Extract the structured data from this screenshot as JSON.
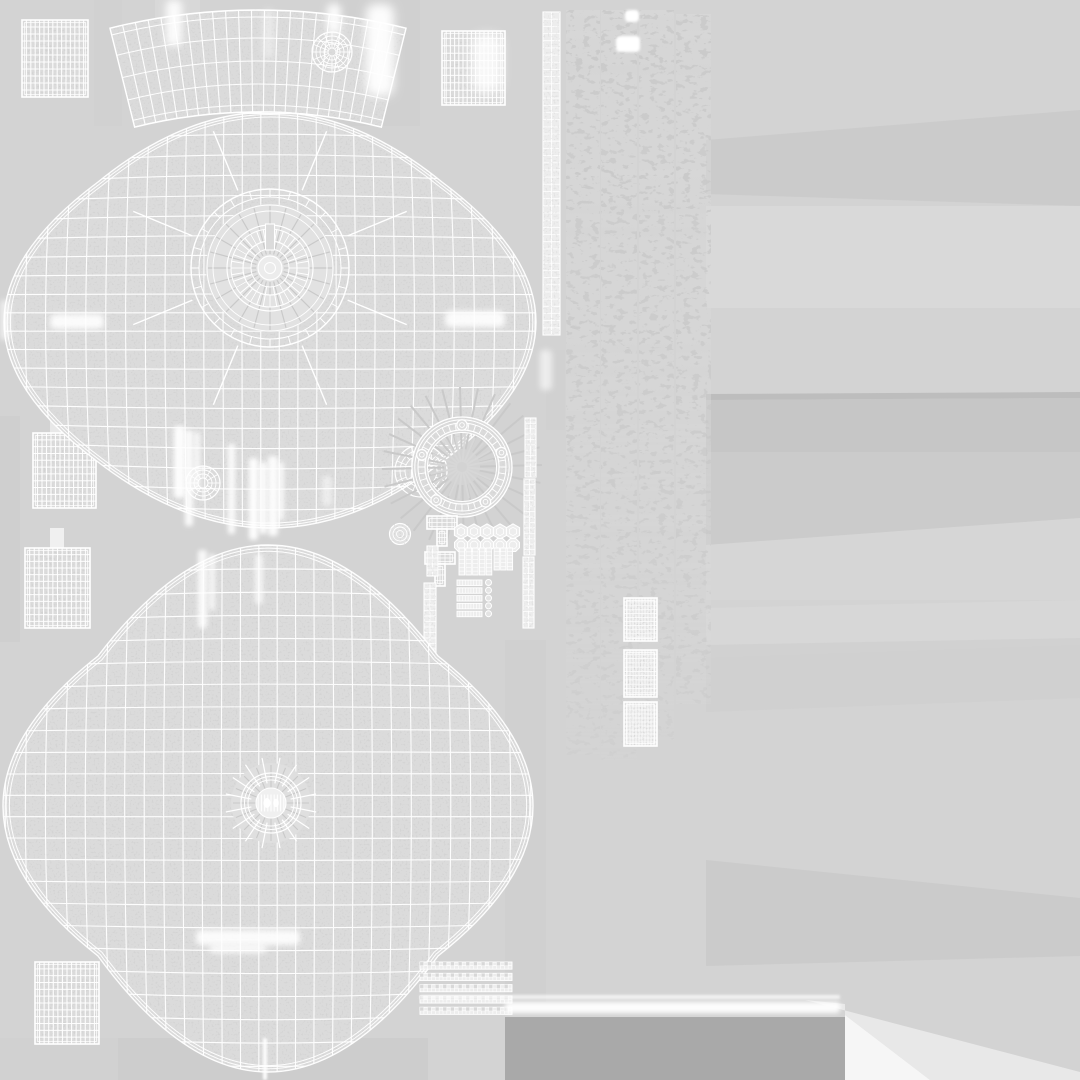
{
  "meta": {
    "title": "UV Wireframe Texture Atlas",
    "description": "Grayscale UV-unwrap wireframe sheet of a 3D drum-style model: two cross-shaped shell islands, top arc band, hoop ring, lugs, tension rods, ladder strips and grid patches on a gray background",
    "canvas": {
      "width": 1080,
      "height": 1080
    }
  },
  "palette": {
    "background": "#d3d3d3",
    "island_fill": "#dbdbdb",
    "island_light": "#e6e6e6",
    "wire": "#ffffff",
    "faint_wire": "#cfcfcf",
    "sunburst": "#c9c9c9",
    "dark_rect": "#a9a9a9",
    "white_patch": "#f6f6f6",
    "pale_corner": "#eaeaea",
    "part_fill": "#ededed"
  },
  "background": {
    "streaks": [
      {
        "pts": [
          [
            706,
            140
          ],
          [
            1080,
            110
          ],
          [
            1080,
            206
          ],
          [
            706,
            194
          ]
        ],
        "f": "#c9c9c9",
        "o": 0.8
      },
      {
        "pts": [
          [
            706,
            206
          ],
          [
            1080,
            206
          ],
          [
            1080,
            308
          ],
          [
            706,
            308
          ]
        ],
        "f": "#dcdcdc",
        "o": 0.7
      },
      {
        "pts": [
          [
            706,
            394
          ],
          [
            1080,
            392
          ],
          [
            1080,
            398
          ],
          [
            706,
            400
          ]
        ],
        "f": "#ababab",
        "o": 0.55
      },
      {
        "pts": [
          [
            706,
            400
          ],
          [
            1080,
            398
          ],
          [
            1080,
            452
          ],
          [
            706,
            452
          ]
        ],
        "f": "#c3c3c3",
        "o": 0.8
      },
      {
        "pts": [
          [
            706,
            452
          ],
          [
            1080,
            452
          ],
          [
            1080,
            518
          ],
          [
            706,
            545
          ]
        ],
        "f": "#c7c7c7",
        "o": 0.7
      },
      {
        "pts": [
          [
            706,
            545
          ],
          [
            1080,
            518
          ],
          [
            1080,
            600
          ],
          [
            706,
            600
          ]
        ],
        "f": "#d8d8d8",
        "o": 0.6
      },
      {
        "pts": [
          [
            706,
            608
          ],
          [
            1080,
            600
          ],
          [
            1080,
            645
          ],
          [
            706,
            658
          ]
        ],
        "f": "#d9d9d9",
        "o": 0.7
      },
      {
        "pts": [
          [
            706,
            645
          ],
          [
            1080,
            638
          ],
          [
            1080,
            698
          ],
          [
            706,
            712
          ]
        ],
        "f": "#cecece",
        "o": 0.7
      },
      {
        "pts": [
          [
            706,
            860
          ],
          [
            1080,
            898
          ],
          [
            1080,
            956
          ],
          [
            706,
            966
          ]
        ],
        "f": "#c8c8c8",
        "o": 0.75
      },
      {
        "pts": [
          [
            88,
            336
          ],
          [
            122,
            336
          ],
          [
            122,
            448
          ],
          [
            88,
            448
          ]
        ],
        "f": "#c8c8c8",
        "o": 0.5
      },
      {
        "pts": [
          [
            294,
            328
          ],
          [
            368,
            328
          ],
          [
            368,
            434
          ],
          [
            294,
            434
          ]
        ],
        "f": "#cccccc",
        "o": 0.5
      },
      {
        "pts": [
          [
            338,
            0
          ],
          [
            420,
            0
          ],
          [
            420,
            126
          ],
          [
            338,
            126
          ]
        ],
        "f": "#cdcdcd",
        "o": 0.45
      },
      {
        "pts": [
          [
            94,
            0
          ],
          [
            122,
            0
          ],
          [
            122,
            126
          ],
          [
            94,
            126
          ]
        ],
        "f": "#d0d0d0",
        "o": 0.5
      },
      {
        "pts": [
          [
            0,
            416
          ],
          [
            20,
            416
          ],
          [
            20,
            642
          ],
          [
            0,
            642
          ]
        ],
        "f": "#cbcbcb",
        "o": 0.5
      },
      {
        "pts": [
          [
            505,
            640
          ],
          [
            546,
            640
          ],
          [
            546,
            1002
          ],
          [
            505,
            1002
          ]
        ],
        "f": "#cbcbcb",
        "o": 0.45
      },
      {
        "pts": [
          [
            118,
            1038
          ],
          [
            428,
            1038
          ],
          [
            428,
            1080
          ],
          [
            118,
            1080
          ]
        ],
        "f": "#c5c5c5",
        "o": 0.4
      },
      {
        "pts": [
          [
            0,
            1038
          ],
          [
            118,
            1038
          ],
          [
            118,
            1080
          ],
          [
            0,
            1080
          ]
        ],
        "f": "#cfcfcf",
        "o": 0.5
      },
      {
        "pts": [
          [
            50,
            384
          ],
          [
            64,
            384
          ],
          [
            64,
            433
          ],
          [
            50,
            433
          ]
        ],
        "f": "#e9e9e9",
        "o": 0.95
      },
      {
        "pts": [
          [
            50,
            528
          ],
          [
            64,
            528
          ],
          [
            64,
            548
          ],
          [
            50,
            548
          ]
        ],
        "f": "#f1f1f1",
        "o": 0.95
      },
      {
        "pts": [
          [
            155,
            0
          ],
          [
            200,
            0
          ],
          [
            200,
            40
          ],
          [
            155,
            40
          ]
        ],
        "f": "#dddddd",
        "o": 0.5
      },
      {
        "pts": [
          [
            430,
            350
          ],
          [
            470,
            350
          ],
          [
            470,
            420
          ],
          [
            430,
            420
          ]
        ],
        "f": "#d8d8d8",
        "o": 0.5
      },
      {
        "pts": [
          [
            546,
            350
          ],
          [
            565,
            350
          ],
          [
            565,
            430
          ],
          [
            546,
            430
          ]
        ],
        "f": "#cfcfcf",
        "o": 0.5
      }
    ],
    "bottom_right": {
      "dark": {
        "pts": [
          [
            505,
            1017
          ],
          [
            845,
            1017
          ],
          [
            845,
            1080
          ],
          [
            505,
            1080
          ]
        ],
        "f": "#a9a9a9",
        "o": 1
      },
      "wedge": {
        "pts": [
          [
            845,
            1015
          ],
          [
            930,
            1080
          ],
          [
            845,
            1080
          ]
        ],
        "f": "#f6f6f6",
        "o": 1
      },
      "corner": {
        "pts": [
          [
            805,
            1000
          ],
          [
            1080,
            1072
          ],
          [
            1080,
            1080
          ],
          [
            930,
            1080
          ],
          [
            845,
            1015
          ],
          [
            845,
            1004
          ]
        ],
        "f": "#eaeaea",
        "o": 0.9
      }
    }
  },
  "islands": {
    "patches": [
      {
        "name": "grid-patch-top-left",
        "x": 22,
        "y": 20,
        "w": 66,
        "h": 77,
        "cols": 15,
        "rows": 11
      },
      {
        "name": "grid-patch-top-mid",
        "x": 442,
        "y": 31,
        "w": 63,
        "h": 74,
        "cols": 15,
        "rows": 10
      },
      {
        "name": "grid-patch-mid-left-a",
        "x": 33,
        "y": 433,
        "w": 63,
        "h": 75,
        "cols": 14,
        "rows": 11
      },
      {
        "name": "grid-patch-mid-left-b",
        "x": 25,
        "y": 548,
        "w": 65,
        "h": 80,
        "cols": 14,
        "rows": 12
      },
      {
        "name": "grid-patch-bottom-left",
        "x": 35,
        "y": 962,
        "w": 64,
        "h": 82,
        "cols": 14,
        "rows": 12
      }
    ],
    "right_grids": [
      {
        "name": "grid-patch-right-1",
        "x": 624,
        "y": 598,
        "w": 33,
        "h": 43,
        "cols": 11,
        "rows": 11
      },
      {
        "name": "grid-patch-right-2",
        "x": 624,
        "y": 650,
        "w": 33,
        "h": 47,
        "cols": 11,
        "rows": 11
      },
      {
        "name": "grid-patch-right-3",
        "x": 624,
        "y": 702,
        "w": 33,
        "h": 44,
        "cols": 11,
        "rows": 11
      }
    ],
    "band_top": {
      "cx": 258,
      "cyc": 622,
      "rOut": 612,
      "rIn": 510,
      "halfAngleDeg": 14,
      "cols": 23,
      "rowRadii": [
        612,
        605,
        584,
        561,
        538,
        517,
        510
      ],
      "wheel": {
        "cx": 332,
        "cy": 52,
        "radii": [
          20,
          16,
          12,
          8,
          4
        ],
        "spokes": 16
      }
    },
    "shell_top": {
      "cx": 270,
      "cy": 322,
      "rt": 210,
      "rb": 206,
      "rl": 266,
      "rr": 266,
      "nx": 172,
      "ny": 140,
      "cols": 29,
      "rows": 23,
      "bulge": 26,
      "wheels": [
        {
          "cx": 203,
          "cy": 483,
          "radii": [
            17,
            13,
            9,
            5
          ],
          "spokes": 12
        },
        {
          "cx": 421,
          "cy": 471,
          "radii": [
            26,
            21,
            16
          ],
          "spokes": 16
        }
      ]
    },
    "rings_top": {
      "cx": 270,
      "cy": 268,
      "outer": [
        79,
        71
      ],
      "outerTicks": 24,
      "mid": [
        63,
        57
      ],
      "inner": [
        43,
        39
      ],
      "innerTicks": 36,
      "core": [
        27,
        19
      ],
      "coreTicks": 18,
      "hub": 12,
      "hole": 5.5,
      "spokes": 8,
      "spokeR1": 84,
      "spokeR2": 148,
      "slot": {
        "x": 265.5,
        "y": 224,
        "w": 9,
        "h": 26
      }
    },
    "hoop": {
      "cx": 462,
      "cy": 467,
      "outerRims": [
        50,
        47.2,
        44
      ],
      "innerRims": [
        37,
        34.5
      ],
      "ticks": 40,
      "boltAngles": [
        90,
        163,
        20,
        232,
        304
      ],
      "boltR": 42,
      "boltSize": 5.2
    },
    "shell_bottom": {
      "cx": 268,
      "cy": 806,
      "rt": 261,
      "rb": 266,
      "rl": 265,
      "rr": 265,
      "nx": 170,
      "ny": 150,
      "cols": 29,
      "rows": 25,
      "bulge": 24
    },
    "grommet": {
      "cx": 271,
      "cy": 803,
      "discR": 40,
      "spokes": 16,
      "spokeR1": 20,
      "spokeR2": 46,
      "rings": [
        30,
        26.5,
        23
      ],
      "coreR": 15,
      "bars": 9,
      "barHalf": 8.5
    },
    "ladder_top": {
      "x": 543,
      "y": 12,
      "w": 17,
      "h": 323,
      "rungs": 45
    },
    "cluster": {
      "brackets": [
        {
          "x": 427,
          "y": 516,
          "w": 30,
          "h": 13,
          "sx": 437,
          "sy": 529,
          "sw": 10,
          "sh": 17
        },
        {
          "x": 425,
          "y": 552,
          "w": 30,
          "h": 12,
          "sx": 435,
          "sy": 564,
          "sw": 10,
          "sh": 22
        }
      ],
      "hex_y": 531.5,
      "hex_xs": [
        461,
        474,
        487,
        500,
        513
      ],
      "hex_r": 7.6,
      "washer_y": 545,
      "washer_r": 7,
      "rodsA": {
        "x": 459,
        "y": 548,
        "colW": 5.6,
        "gap": 1.2,
        "n": 5,
        "h": 27,
        "rungs": 7
      },
      "rodsB": {
        "x": 494,
        "y": 548,
        "colW": 5.4,
        "gap": 1.2,
        "n": 3,
        "h": 22,
        "rungs": 6
      },
      "strips": {
        "x": 457,
        "y": 580,
        "w": 25,
        "h": 5.5,
        "gap": 7.8,
        "n": 5,
        "ticks": 9
      },
      "dots": {
        "x": 488.5,
        "ys": [
          582.5,
          590.3,
          598.1,
          605.9,
          613.7
        ],
        "r": 3
      },
      "ladderL": [
        {
          "x": 427,
          "y": 546,
          "w": 11,
          "h": 30
        },
        {
          "x": 424,
          "y": 583,
          "w": 12,
          "h": 77
        }
      ],
      "ladderR": [
        {
          "x": 525,
          "y": 418,
          "w": 11,
          "h": 59
        },
        {
          "x": 524,
          "y": 479,
          "w": 11,
          "h": 76
        },
        {
          "x": 523,
          "y": 557,
          "w": 11,
          "h": 71
        }
      ],
      "knob": {
        "cx": 400,
        "cy": 534,
        "r": [
          10.5,
          7,
          3.5
        ]
      }
    },
    "noise_columns": [
      {
        "x": 566,
        "y": 10,
        "w": 34,
        "h": 745
      },
      {
        "x": 601,
        "y": 10,
        "w": 36,
        "h": 750
      },
      {
        "x": 639,
        "y": 10,
        "w": 35,
        "h": 730
      },
      {
        "x": 676,
        "y": 14,
        "w": 35,
        "h": 690
      }
    ],
    "white_marks": [
      {
        "x": 625,
        "y": 10,
        "w": 14,
        "h": 12
      },
      {
        "x": 616,
        "y": 36,
        "w": 24,
        "h": 16
      }
    ],
    "ribbons": {
      "x": 420,
      "w": 92,
      "h": 7.2,
      "cells": 24,
      "ys": [
        962,
        973.3,
        984.6,
        995.9,
        1007.2
      ]
    }
  },
  "speculars": [
    {
      "x": 166,
      "y": 0,
      "w": 16,
      "h": 46,
      "b": 4,
      "o": 0.9
    },
    {
      "x": 327,
      "y": 4,
      "w": 14,
      "h": 30,
      "b": 4,
      "o": 0.9
    },
    {
      "x": 366,
      "y": 4,
      "w": 28,
      "h": 92,
      "b": 5,
      "o": 0.95
    },
    {
      "x": 264,
      "y": 10,
      "w": 9,
      "h": 48,
      "b": 4,
      "o": 0.5
    },
    {
      "x": 472,
      "y": 34,
      "w": 30,
      "h": 58,
      "b": 5,
      "o": 0.8
    },
    {
      "x": 50,
      "y": 314,
      "w": 54,
      "h": 15,
      "b": 3,
      "o": 0.9
    },
    {
      "x": 445,
      "y": 311,
      "w": 60,
      "h": 16,
      "b": 3,
      "o": 0.9
    },
    {
      "x": 196,
      "y": 930,
      "w": 104,
      "h": 15,
      "b": 3,
      "o": 0.9
    },
    {
      "x": 210,
      "y": 944,
      "w": 56,
      "h": 9,
      "b": 3,
      "o": 0.8
    },
    {
      "x": 174,
      "y": 426,
      "w": 11,
      "h": 72,
      "b": 2.5,
      "o": 0.95
    },
    {
      "x": 185,
      "y": 430,
      "w": 8,
      "h": 96,
      "b": 2.5,
      "o": 0.9
    },
    {
      "x": 194,
      "y": 432,
      "w": 6,
      "h": 58,
      "b": 2.5,
      "o": 0.8
    },
    {
      "x": 228,
      "y": 444,
      "w": 7,
      "h": 90,
      "b": 2.5,
      "o": 0.9
    },
    {
      "x": 249,
      "y": 458,
      "w": 9,
      "h": 82,
      "b": 2.5,
      "o": 0.95
    },
    {
      "x": 259,
      "y": 462,
      "w": 8,
      "h": 72,
      "b": 2.5,
      "o": 0.9
    },
    {
      "x": 268,
      "y": 456,
      "w": 10,
      "h": 80,
      "b": 2.5,
      "o": 0.9
    },
    {
      "x": 278,
      "y": 462,
      "w": 6,
      "h": 58,
      "b": 2.5,
      "o": 0.8
    },
    {
      "x": 322,
      "y": 476,
      "w": 10,
      "h": 30,
      "b": 2.5,
      "o": 0.5
    },
    {
      "x": 198,
      "y": 550,
      "w": 9,
      "h": 78,
      "b": 2.5,
      "o": 0.85
    },
    {
      "x": 209,
      "y": 554,
      "w": 6,
      "h": 56,
      "b": 2.5,
      "o": 0.75
    },
    {
      "x": 255,
      "y": 554,
      "w": 8,
      "h": 50,
      "b": 2.5,
      "o": 0.7
    },
    {
      "x": 263,
      "y": 1038,
      "w": 4,
      "h": 42,
      "b": 1.5,
      "o": 0.95
    },
    {
      "x": 505,
      "y": 1002,
      "w": 335,
      "h": 11,
      "b": 2,
      "o": 0.95
    },
    {
      "x": 420,
      "y": 995,
      "w": 420,
      "h": 4,
      "b": 1.5,
      "o": 0.7
    },
    {
      "x": 540,
      "y": 350,
      "w": 12,
      "h": 40,
      "b": 3,
      "o": 0.6
    },
    {
      "x": 0,
      "y": 300,
      "w": 10,
      "h": 40,
      "b": 3,
      "o": 0.6
    }
  ]
}
